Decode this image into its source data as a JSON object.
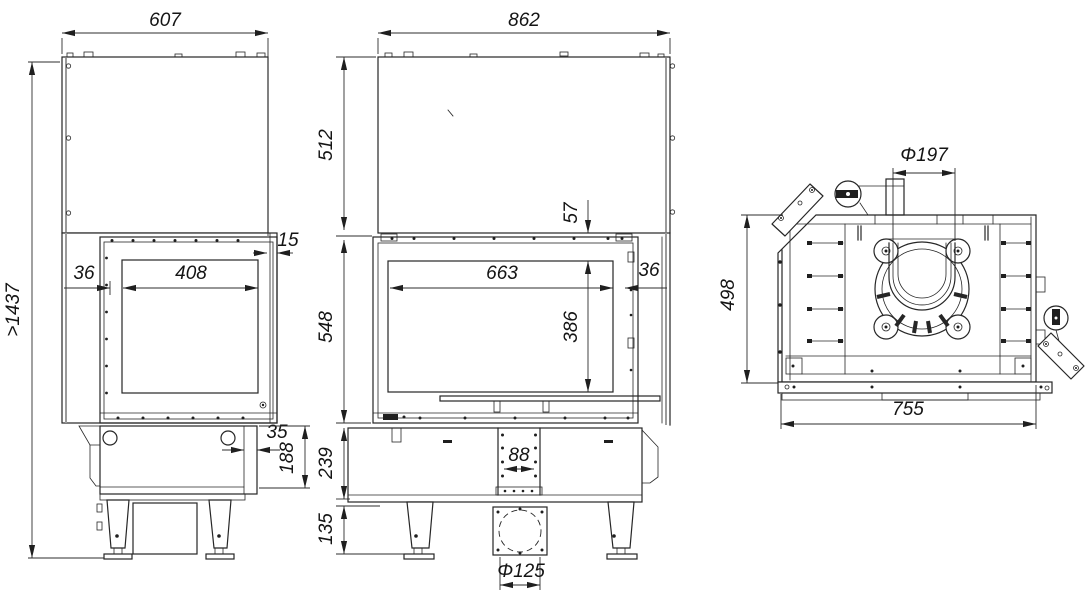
{
  "meta": {
    "type": "technical-drawing",
    "subject": "fireplace insert dimensional drawing (side, front and top views)",
    "units": "mm",
    "background": "#ffffff",
    "line_color": "#262626",
    "dim_text_color": "#141414"
  },
  "views": {
    "side": {
      "label": "side-view",
      "dims": {
        "overall_width": "607",
        "overall_height": ">1437",
        "glass_inset": "36",
        "glass_width": "408",
        "front_offset": "15",
        "base_wall": "35",
        "base_height": "188"
      }
    },
    "front": {
      "label": "front-view",
      "dims": {
        "overall_width": "862",
        "hood_height": "512",
        "frame_top": "57",
        "glass_width": "663",
        "glass_inset": "36",
        "firebox_height": "548",
        "glass_height": "386",
        "base_height": "239",
        "duct_width": "88",
        "feet_height": "135",
        "air_inlet_diameter": "Φ125"
      }
    },
    "top": {
      "label": "top-view",
      "dims": {
        "flue_diameter": "Φ197",
        "overall_depth": "498",
        "overall_width": "755"
      }
    }
  }
}
